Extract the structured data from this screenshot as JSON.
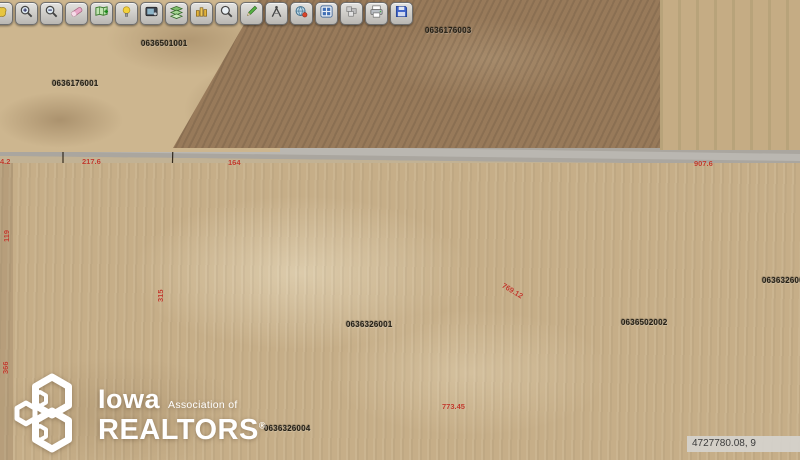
{
  "toolbar": {
    "buttons": [
      {
        "name": "pan-icon"
      },
      {
        "name": "zoom-in-icon"
      },
      {
        "name": "zoom-out-icon"
      },
      {
        "name": "eraser-icon"
      },
      {
        "name": "map-add-icon"
      },
      {
        "name": "identify-icon"
      },
      {
        "name": "screenshot-icon"
      },
      {
        "name": "layers-icon"
      },
      {
        "name": "buildings-icon"
      },
      {
        "name": "search-icon"
      },
      {
        "name": "draw-icon"
      },
      {
        "name": "measure-icon"
      },
      {
        "name": "locate-icon"
      },
      {
        "name": "grid-icon"
      },
      {
        "name": "parcels-icon"
      },
      {
        "name": "print-icon"
      },
      {
        "name": "save-icon"
      }
    ]
  },
  "map": {
    "parcel_labels": [
      {
        "id": "0636501001",
        "x": 141,
        "y": 39
      },
      {
        "id": "0636176003",
        "x": 425,
        "y": 26
      },
      {
        "id": "0636176001",
        "x": 52,
        "y": 79
      },
      {
        "id": "0636326001",
        "x": 346,
        "y": 320
      },
      {
        "id": "0636502002",
        "x": 621,
        "y": 318
      },
      {
        "id": "0636326004",
        "x": 264,
        "y": 424
      },
      {
        "id": "0636326002",
        "x": 762,
        "y": 276
      }
    ],
    "dimension_labels": [
      {
        "text": "4.2",
        "x": 0,
        "y": 157,
        "rot": 0
      },
      {
        "text": "217.6",
        "x": 82,
        "y": 157,
        "rot": 0
      },
      {
        "text": "164",
        "x": 228,
        "y": 158,
        "rot": 0
      },
      {
        "text": "907.6",
        "x": 694,
        "y": 159,
        "rot": 0
      },
      {
        "text": "119",
        "x": 2,
        "y": 242,
        "rot": -90
      },
      {
        "text": "315",
        "x": 156,
        "y": 302,
        "rot": -90
      },
      {
        "text": "366",
        "x": 1,
        "y": 374,
        "rot": -90
      },
      {
        "text": "769.12",
        "x": 505,
        "y": 281,
        "rot": 31
      },
      {
        "text": "773.45",
        "x": 442,
        "y": 402,
        "rot": 0
      }
    ],
    "coordinate_readout": "4727780.08, 9",
    "colors": {
      "selected_parcel": "#35dfd2",
      "boundary": "#1d1408",
      "dimension_text": "#c0392b",
      "parcel_text": "#262116"
    }
  },
  "watermark": {
    "name_top": "Iowa",
    "name_top_suffix": "Association of",
    "name_bottom": "REALTORS",
    "registered": "®"
  }
}
